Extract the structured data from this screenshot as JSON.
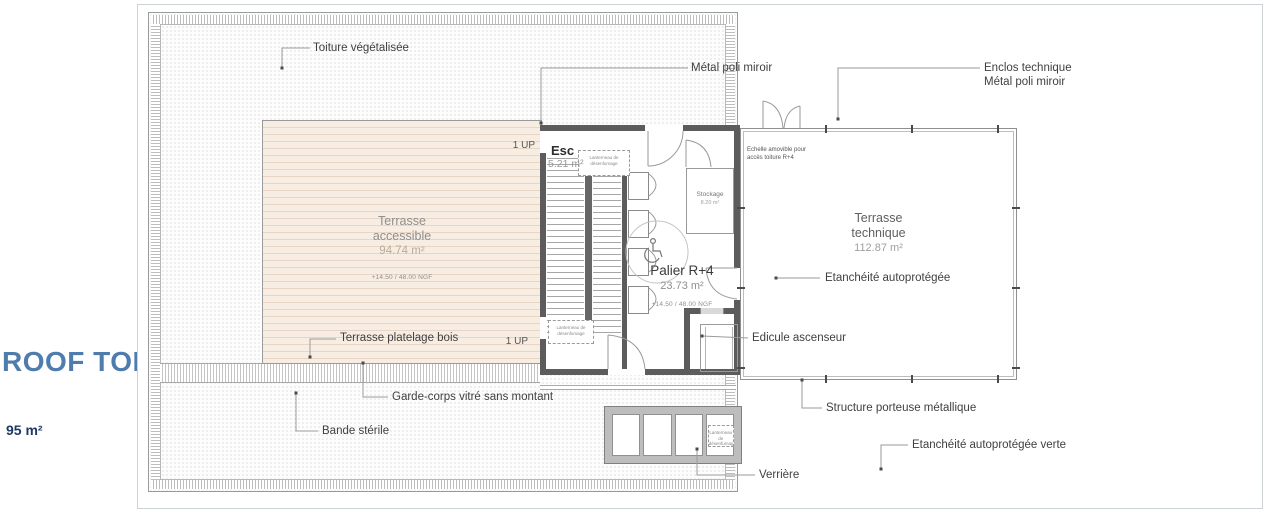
{
  "plan": {
    "title": "ROOF TOP",
    "total_area": "95 m²",
    "title_color": "#4e7dad",
    "area_color": "#1f3864"
  },
  "annotations": {
    "toiture": "Toiture végétalisée",
    "metal": "Métal poli miroir",
    "enclos_l1": "Enclos technique",
    "enclos_l2": "Métal poli miroir",
    "etancheite": "Etanchéité autoprotégée",
    "edicule": "Edicule ascenseur",
    "platelage": "Terrasse platelage bois",
    "garde_corps": "Garde-corps vitré sans montant",
    "bande_sterile": "Bande stérile",
    "structure": "Structure porteuse métallique",
    "etancheite_verte": "Etanchéité autoprotégée verte",
    "verriere": "Verrière",
    "echelle_l1": "Echelle amovible pour",
    "echelle_l2": "accès toiture R+4",
    "up": "1 UP"
  },
  "rooms": {
    "esc": {
      "name": "Esc",
      "area": "5.21 m²"
    },
    "terrasse_accessible": {
      "l1": "Terrasse",
      "l2": "accessible",
      "area": "94.74 m²",
      "level": "+14.50 / 48.00 NGF"
    },
    "terrasse_technique": {
      "l1": "Terrasse",
      "l2": "technique",
      "area": "112.87 m²"
    },
    "palier": {
      "name": "Palier R+4",
      "area": "23.73 m²",
      "level": "+14.50 / 48.00 NGF"
    },
    "stockage": {
      "name": "Stockage",
      "area": "8.20 m²"
    },
    "lanterneau": {
      "l1": "Lanterneau de",
      "l2": "désenfumage"
    }
  }
}
